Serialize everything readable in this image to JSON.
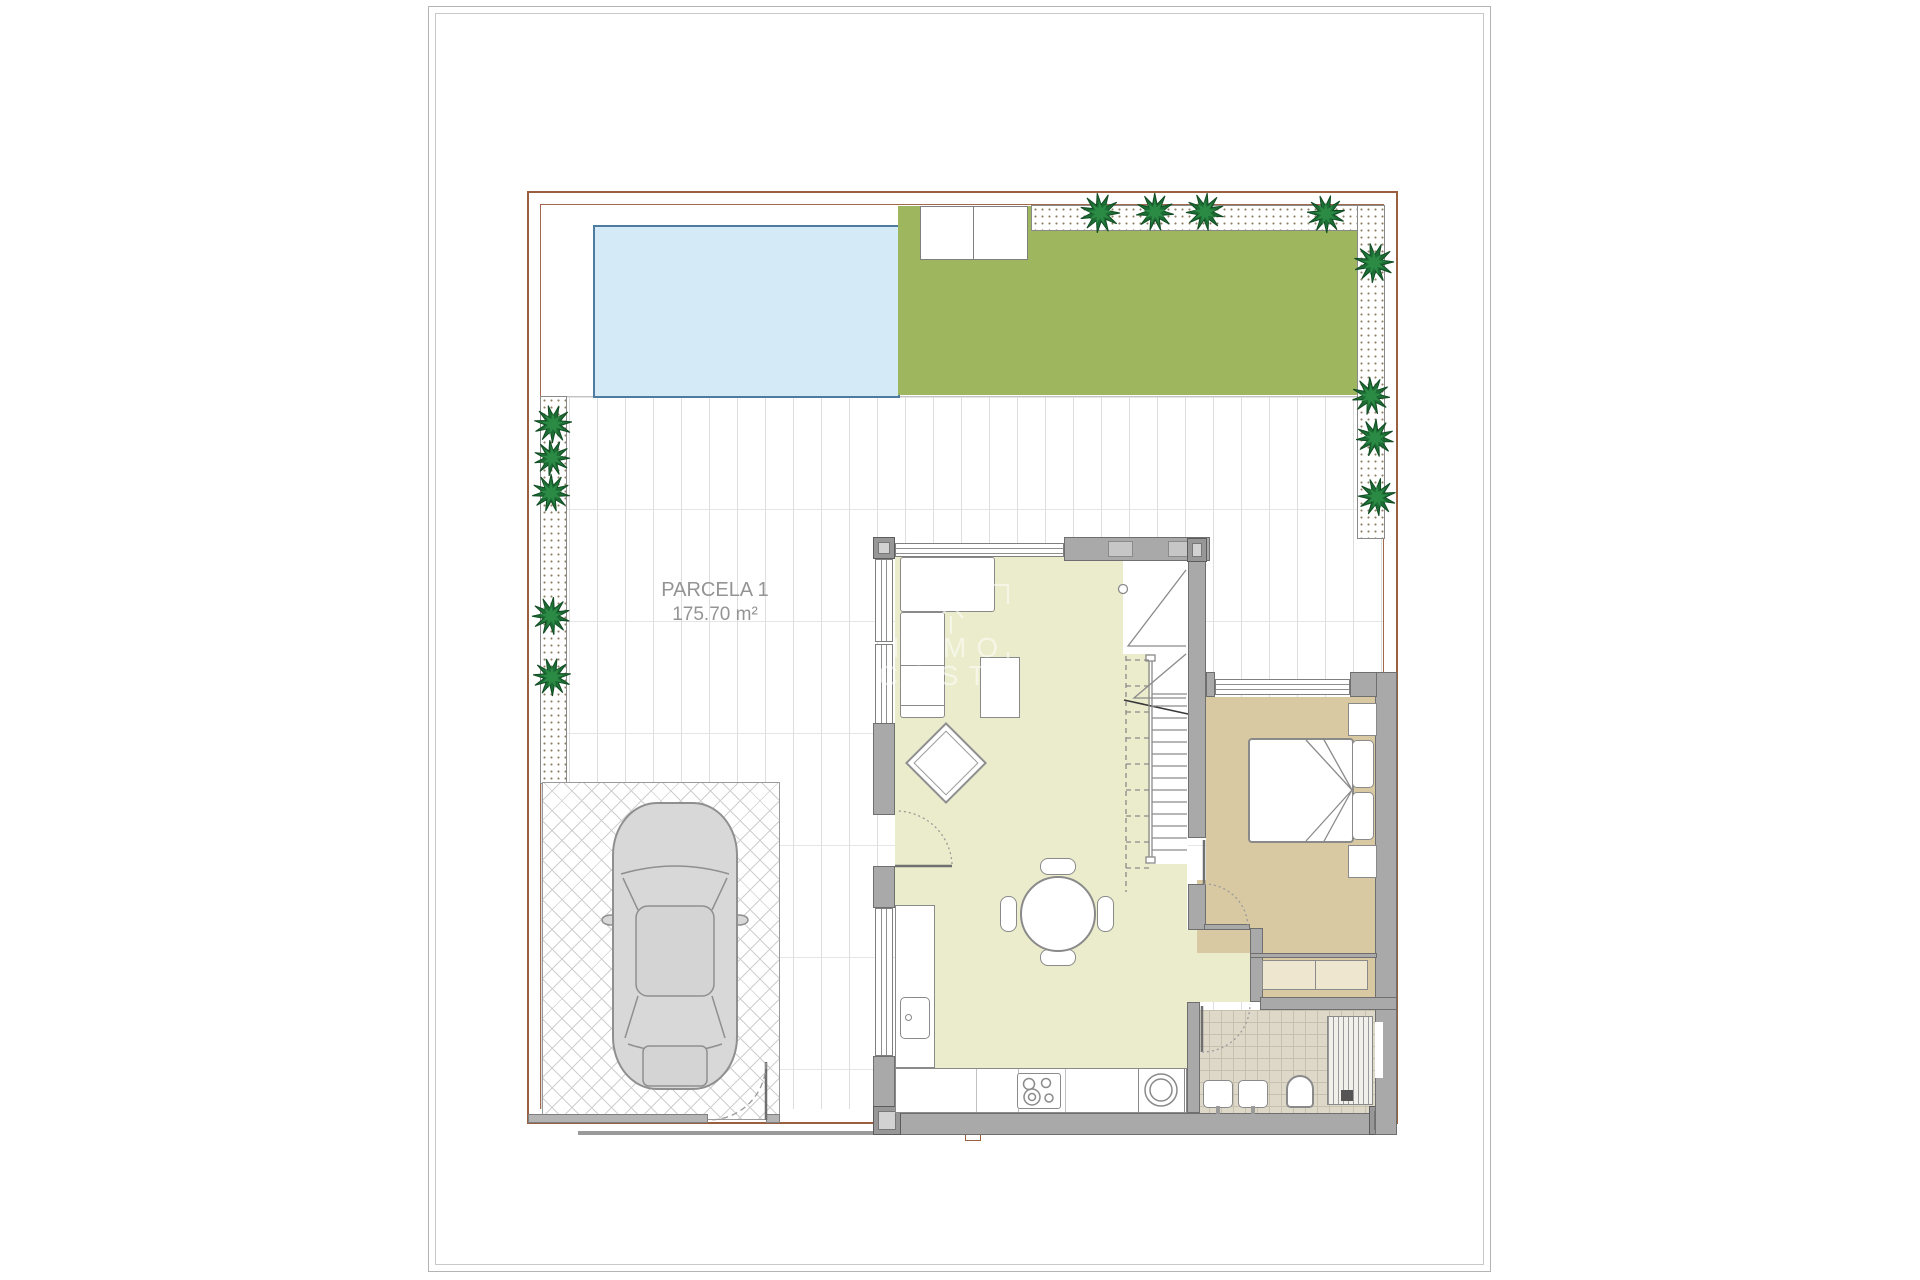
{
  "plan": {
    "parcel_label": "PARCELA 1",
    "parcel_area": "175.70 m²",
    "watermark_line1": "IMMO",
    "watermark_line2": "COSTA"
  },
  "colors": {
    "plot_boundary": "#9a5f3d",
    "pool_fill": "#d4ebf7",
    "pool_border": "#4d7ca0",
    "garden_green": "#9eb65e",
    "living_floor": "#ebeccb",
    "bedroom_floor": "#d8c9a2",
    "bathroom_floor": "#ded8c9",
    "wall_gray": "#a9a9a9",
    "tree_green": "#1e7f3e",
    "car_gray": "#d8d8d8"
  }
}
